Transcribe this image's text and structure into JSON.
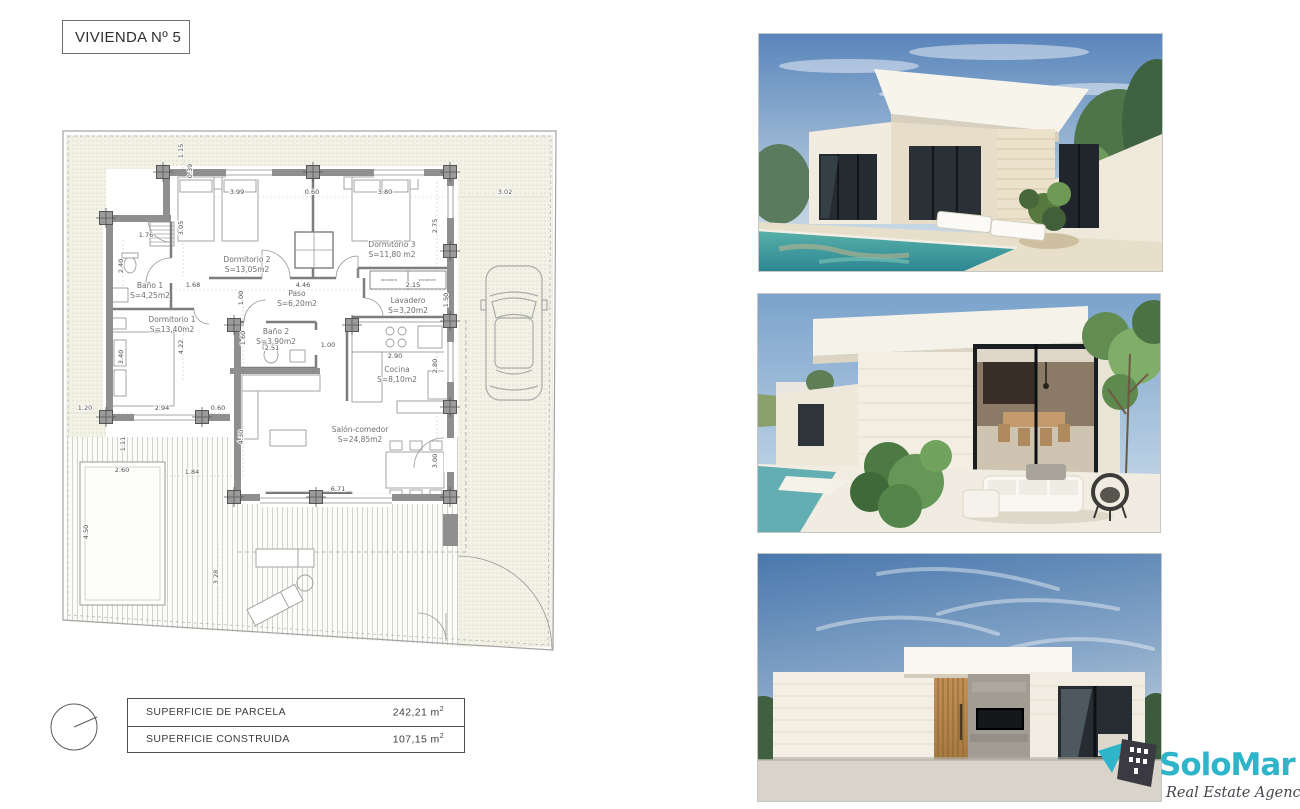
{
  "page": {
    "title": "VIVIENDA Nº 5"
  },
  "plan": {
    "rooms": [
      {
        "name": "Baño 1",
        "area": "S=4,25m2",
        "x": 150,
        "y": 288
      },
      {
        "name": "Dormitorio 1",
        "area": "S=13,40m2",
        "x": 172,
        "y": 322
      },
      {
        "name": "Dormitorio 2",
        "area": "S=13,05m2",
        "x": 247,
        "y": 262
      },
      {
        "name": "Dormitorio 3",
        "area": "S=11,80 m2",
        "x": 392,
        "y": 247
      },
      {
        "name": "Paso",
        "area": "S=6,20m2",
        "x": 297,
        "y": 296
      },
      {
        "name": "Baño 2",
        "area": "S=3,90m2",
        "x": 276,
        "y": 334
      },
      {
        "name": "Lavadero",
        "area": "S=3,20m2",
        "x": 408,
        "y": 303
      },
      {
        "name": "Cocina",
        "area": "S=8,10m2",
        "x": 397,
        "y": 372
      },
      {
        "name": "Salón-comedor",
        "area": "S=24,85m2",
        "x": 360,
        "y": 432
      }
    ],
    "appliances": [
      {
        "label": "lavadora",
        "x": 389,
        "y": 281
      },
      {
        "label": "secadora",
        "x": 427,
        "y": 281
      }
    ],
    "dims": [
      {
        "t": "1.15",
        "x": 183,
        "y": 151,
        "v": true
      },
      {
        "t": "0.39",
        "x": 192,
        "y": 171,
        "v": true
      },
      {
        "t": "3.99",
        "x": 237,
        "y": 194
      },
      {
        "t": "0.60",
        "x": 312,
        "y": 194
      },
      {
        "t": "3.80",
        "x": 385,
        "y": 194
      },
      {
        "t": "3.02",
        "x": 505,
        "y": 194
      },
      {
        "t": "3.05",
        "x": 183,
        "y": 228,
        "v": true
      },
      {
        "t": "2.75",
        "x": 437,
        "y": 226,
        "v": true
      },
      {
        "t": "1.76",
        "x": 146,
        "y": 237
      },
      {
        "t": "2.40",
        "x": 123,
        "y": 266,
        "v": true
      },
      {
        "t": "1.68",
        "x": 193,
        "y": 287
      },
      {
        "t": "4.46",
        "x": 303,
        "y": 287
      },
      {
        "t": "2.15",
        "x": 413,
        "y": 287
      },
      {
        "t": "1.00",
        "x": 243,
        "y": 298,
        "v": true
      },
      {
        "t": "1.50",
        "x": 448,
        "y": 300,
        "v": true
      },
      {
        "t": "1.60",
        "x": 245,
        "y": 338,
        "v": true
      },
      {
        "t": "2.51",
        "x": 272,
        "y": 350
      },
      {
        "t": "1.00",
        "x": 328,
        "y": 347
      },
      {
        "t": "2.90",
        "x": 395,
        "y": 358
      },
      {
        "t": "2.80",
        "x": 437,
        "y": 366,
        "v": true
      },
      {
        "t": "3.40",
        "x": 123,
        "y": 357,
        "v": true
      },
      {
        "t": "4.22",
        "x": 183,
        "y": 347,
        "v": true
      },
      {
        "t": "1.20",
        "x": 85,
        "y": 410
      },
      {
        "t": "2.94",
        "x": 162,
        "y": 410
      },
      {
        "t": "0.60",
        "x": 218,
        "y": 410
      },
      {
        "t": "4.30",
        "x": 243,
        "y": 437,
        "v": true
      },
      {
        "t": "1.11",
        "x": 125,
        "y": 444,
        "v": true
      },
      {
        "t": "2.60",
        "x": 122,
        "y": 472
      },
      {
        "t": "1.84",
        "x": 192,
        "y": 474
      },
      {
        "t": "3.00",
        "x": 437,
        "y": 461,
        "v": true
      },
      {
        "t": "6.71",
        "x": 338,
        "y": 491
      },
      {
        "t": "4.50",
        "x": 88,
        "y": 532,
        "v": true
      },
      {
        "t": "3.28",
        "x": 218,
        "y": 577,
        "v": true
      }
    ]
  },
  "summary": {
    "rows": [
      {
        "label": "SUPERFICIE DE PARCELA",
        "value": "242,21 m",
        "sup": "2"
      },
      {
        "label": "SUPERFICIE CONSTRUIDA",
        "value": "107,15 m",
        "sup": "2"
      }
    ]
  },
  "photos": [
    {
      "label": "exterior-pool-view"
    },
    {
      "label": "terrace-view"
    },
    {
      "label": "front-elevation-view"
    }
  ],
  "logo": {
    "name": "SoloMar",
    "tagline": "Real Estate Agency",
    "accent": "#2fb5ca",
    "dark": "#43424a"
  }
}
